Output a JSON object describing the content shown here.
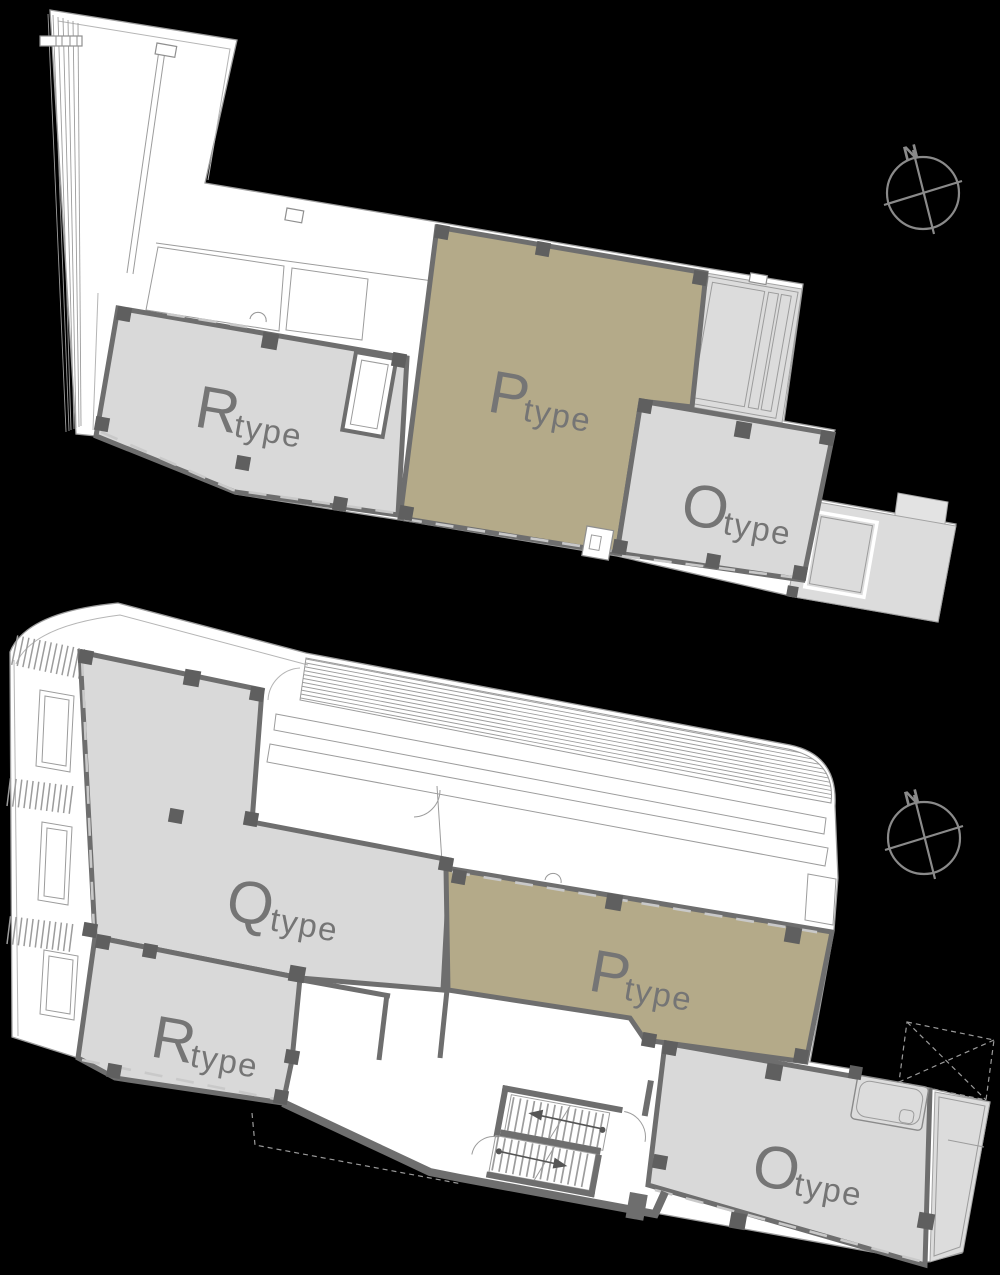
{
  "colors": {
    "background": "#000000",
    "floor_white": "#ffffff",
    "line_gray": "#9c9c9c",
    "unit_gray": "#d9d9d9",
    "unit_khaki": "#b4aa89",
    "wall_gray": "#6e6e6e",
    "column_gray": "#5f5f5f",
    "balcony_gray": "#dcdcdc",
    "terrace_gray": "#e3e3e3",
    "label_gray": "#757575",
    "compass_gray": "#8a8a8a"
  },
  "compass": {
    "north_label": "N"
  },
  "plans": {
    "upper": {
      "units": {
        "r": {
          "letter": "R",
          "suffix": "type"
        },
        "p": {
          "letter": "P",
          "suffix": "type"
        },
        "o": {
          "letter": "O",
          "suffix": "type"
        }
      }
    },
    "lower": {
      "units": {
        "q": {
          "letter": "Q",
          "suffix": "type"
        },
        "r": {
          "letter": "R",
          "suffix": "type"
        },
        "p": {
          "letter": "P",
          "suffix": "type"
        },
        "o": {
          "letter": "O",
          "suffix": "type"
        }
      }
    }
  }
}
